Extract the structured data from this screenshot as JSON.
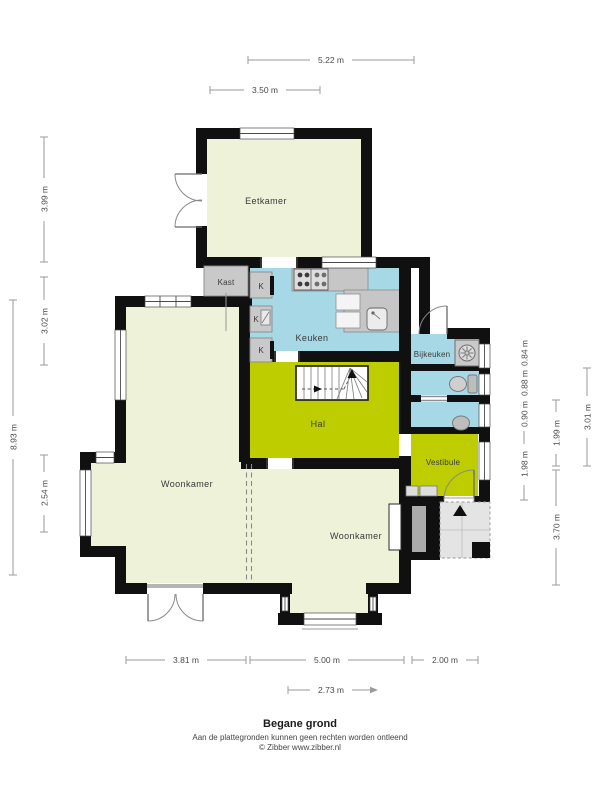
{
  "title": "Begane grond",
  "disclaimer": "Aan de plattegronden kunnen geen rechten worden ontleend",
  "credit": "© Zibber www.zibber.nl",
  "rooms": {
    "eetkamer": "Eetkamer",
    "kast": "Kast",
    "k": "K",
    "keuken": "Keuken",
    "bijkeuken": "Bijkeuken",
    "hal": "Hal",
    "vestibule": "Vestibule",
    "woonkamer": "Woonkamer"
  },
  "dimensions": {
    "top": [
      "5.22 m",
      "3.50 m"
    ],
    "left": [
      "3.99 m",
      "3.02 m",
      "8.93 m",
      "2.54 m"
    ],
    "right": [
      "0.84 m",
      "0.88 m",
      "0.90 m",
      "1.98 m",
      "1.99 m",
      "3.70 m",
      "3.01 m"
    ],
    "bottom": [
      "3.81 m",
      "5.00 m",
      "2.00 m",
      "2.73 m"
    ]
  },
  "colors": {
    "room_pale": "#edf2d8",
    "room_olive": "#bdcd00",
    "room_blue": "#a7d8e6",
    "room_gray": "#c9c9c9",
    "wall": "#101010",
    "porch": "#e4e4e4"
  },
  "icons": {
    "stairs": "stairs-icon",
    "stove": "stove-icon",
    "sink": "sink-icon",
    "washing_machine": "washing-machine-icon",
    "toilet": "toilet-icon",
    "basin": "basin-icon",
    "boiler": "boiler-icon",
    "entrance_arrow": "entrance-arrow-icon"
  }
}
